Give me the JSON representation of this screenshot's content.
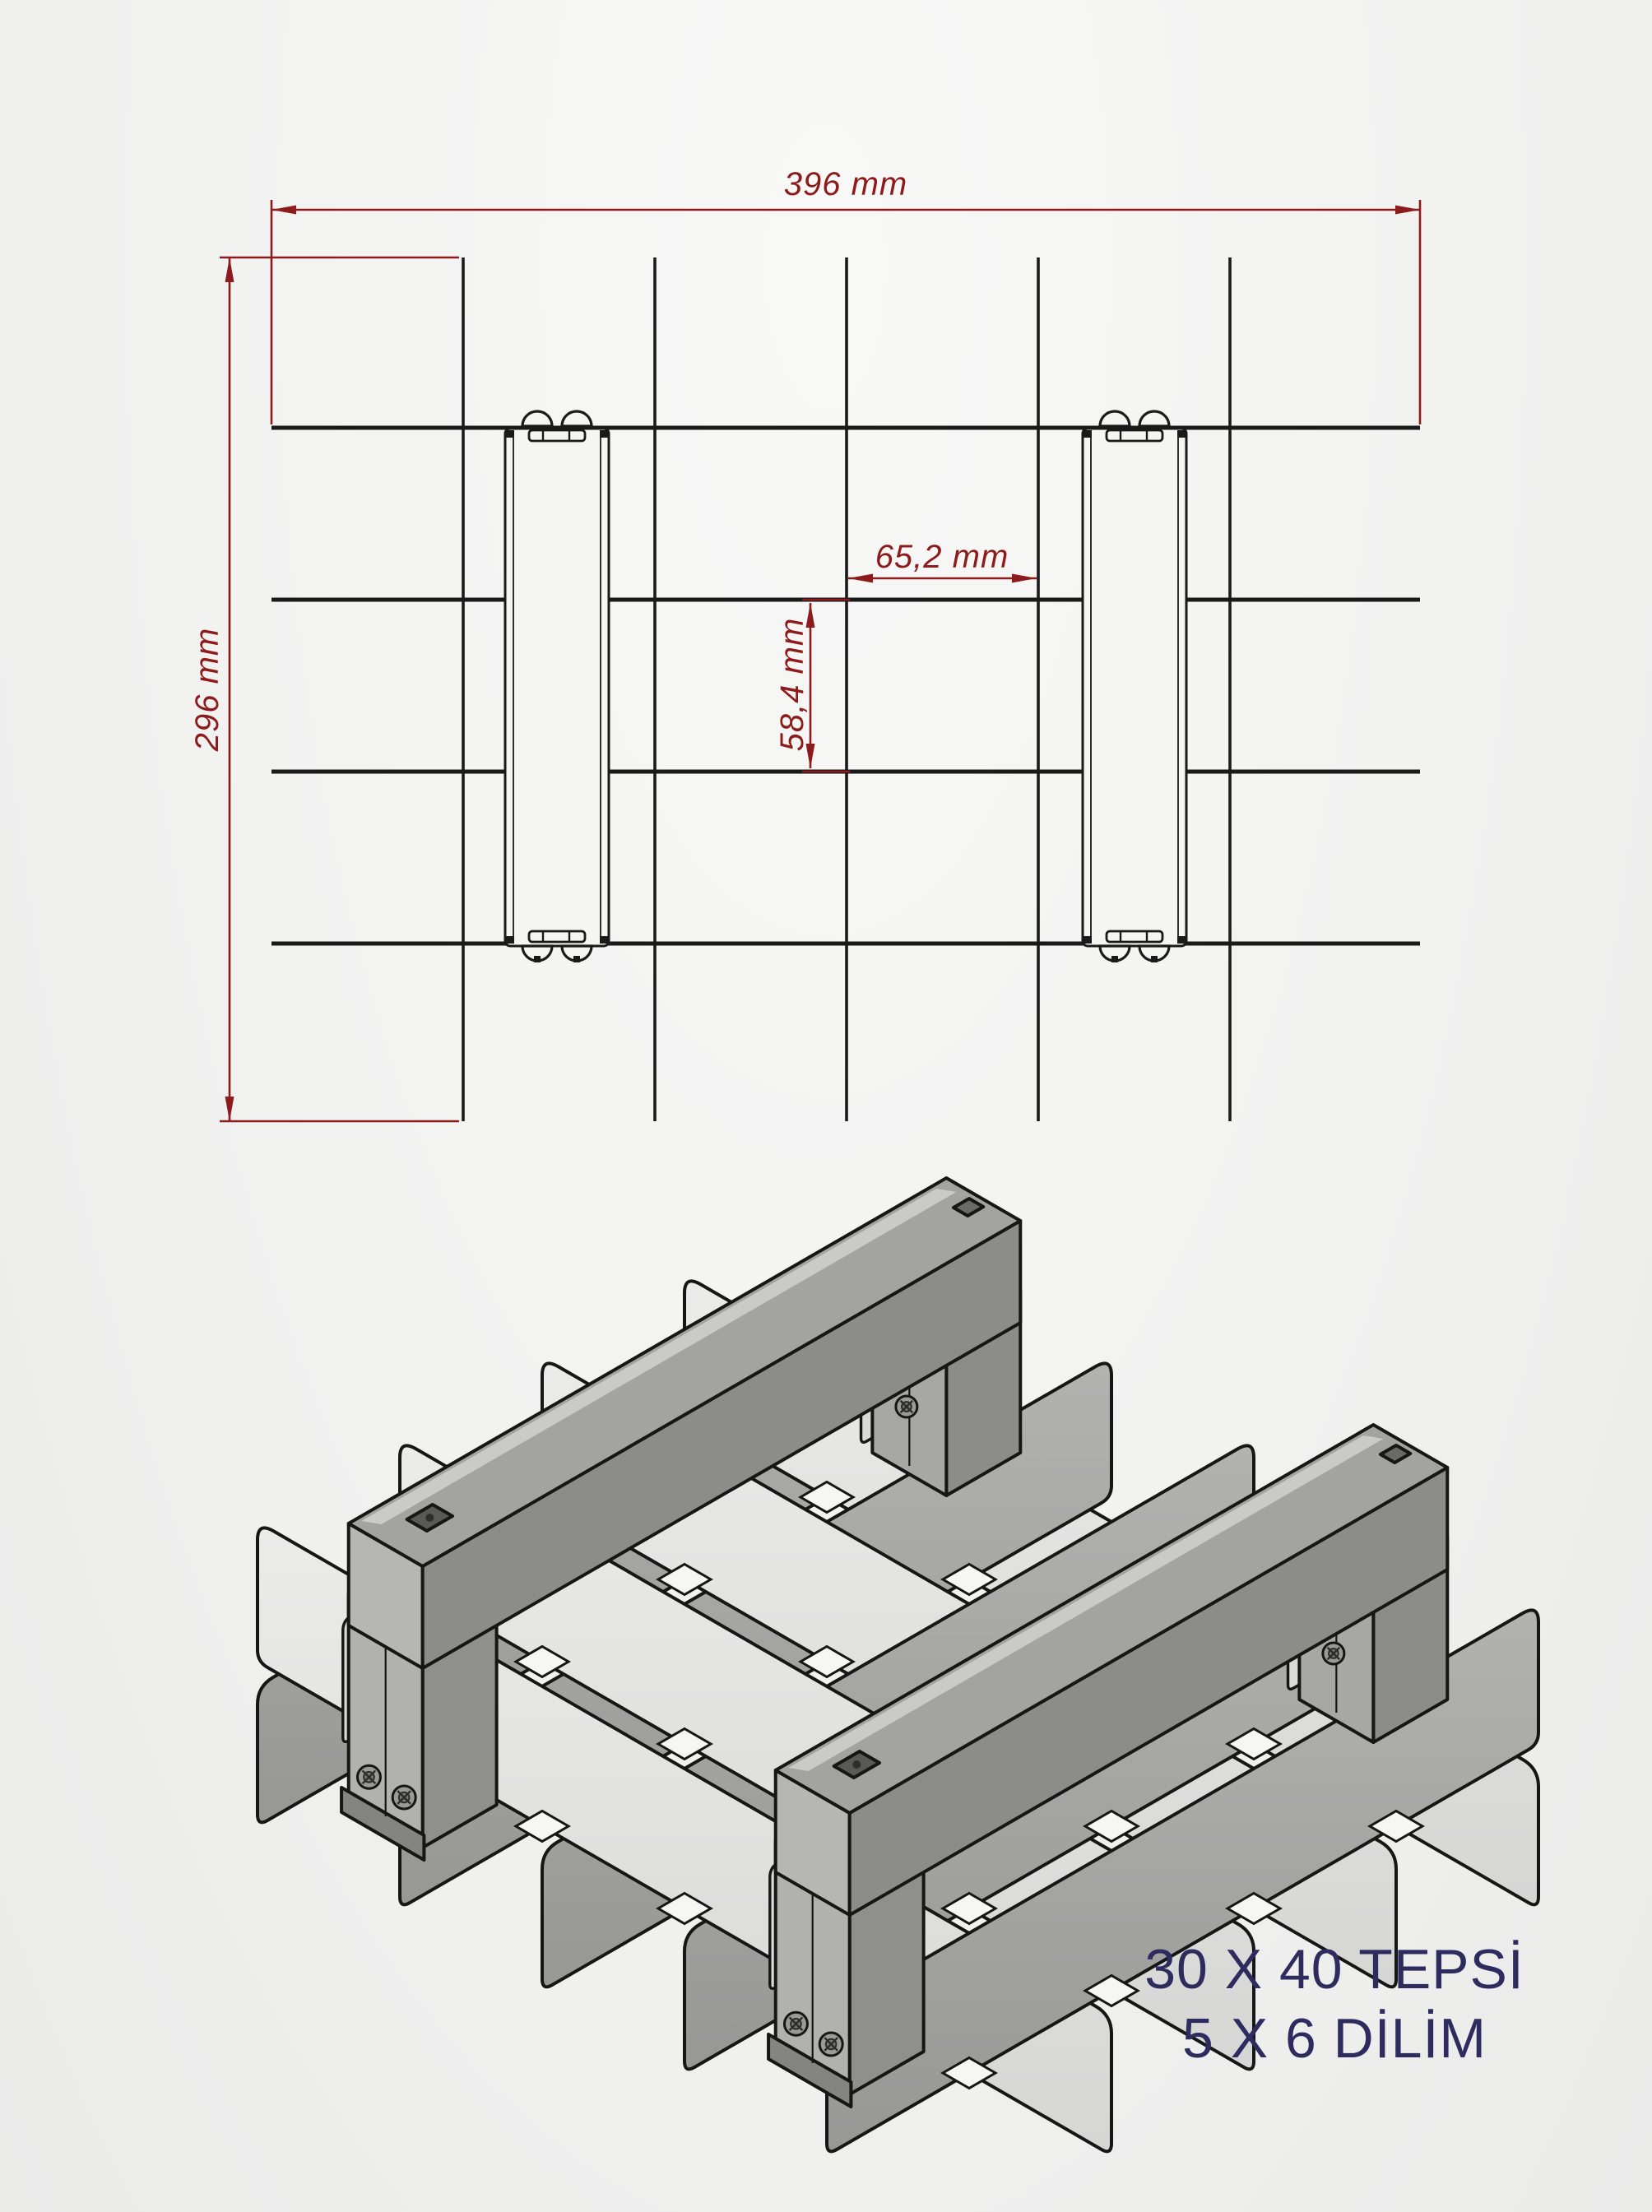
{
  "page": {
    "background_light": "#f5f5f4",
    "background_dark": "#eaeae9"
  },
  "drawing": {
    "dimension_color": "#8e1b1b",
    "line_color": "#1a1a1a",
    "dimensions": {
      "total_width": "396 mm",
      "total_height": "296 mm",
      "cell_width": "65,2 mm",
      "cell_height": "58,4 mm"
    },
    "grid": {
      "columns": 6,
      "rows": 5,
      "cross_dividers": 5,
      "long_dividers": 4,
      "handle_rails": 2
    }
  },
  "iso_colors": {
    "outline": "#161616",
    "panel_light_top": "#ebebea",
    "panel_light_bottom": "#d6d6d5",
    "panel_mid_top": "#b2b2b1",
    "panel_mid_bottom": "#979796",
    "gap_fill": "#f6f6f5",
    "handle_top": "#a3a3a2",
    "handle_side": "#8c8c8b",
    "handle_cap": "#b6b6b5",
    "handle_highlight": "#cacac9",
    "clamp_plate": "#dadad9"
  },
  "caption": {
    "color": "#2e2c5e",
    "line1": "30 X 40 TEPSİ",
    "line2": "5 X 6 DİLİM"
  }
}
